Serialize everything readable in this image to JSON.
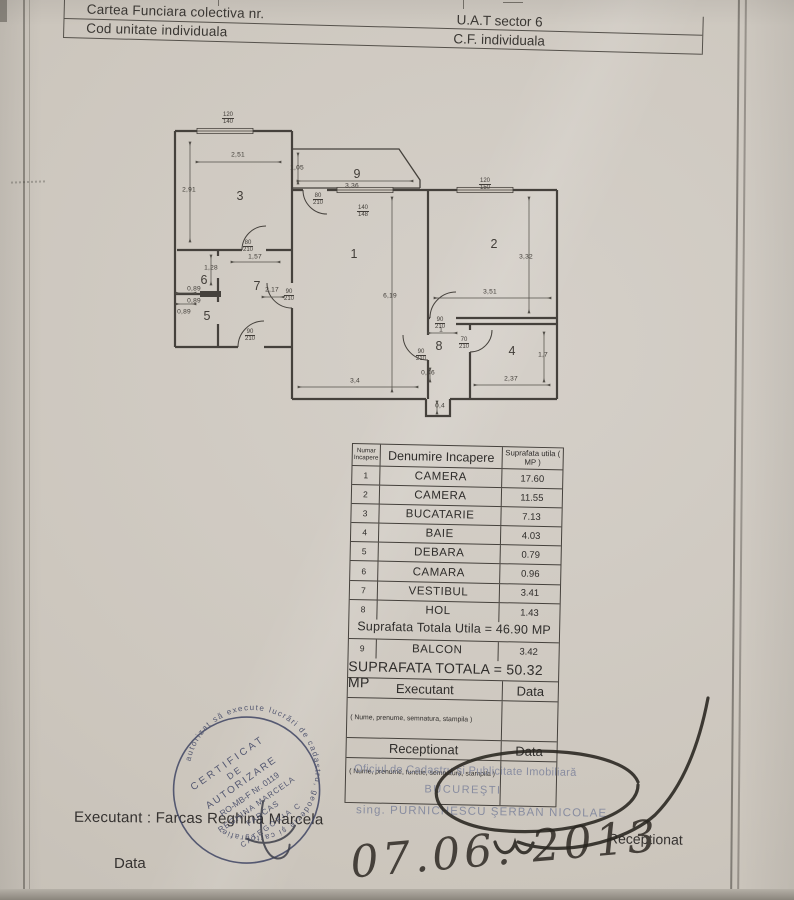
{
  "header": {
    "rows": [
      {
        "left": "Cartea Funciara colectiva nr.",
        "right": "U.A.T sector 6"
      },
      {
        "left": "Cod unitate individuala",
        "right": "C.F. individuala"
      }
    ]
  },
  "floorplan": {
    "room_numbers": [
      {
        "t": "3",
        "x": 240,
        "y": 196
      },
      {
        "t": "9",
        "x": 357,
        "y": 174
      },
      {
        "t": "1",
        "x": 354,
        "y": 254
      },
      {
        "t": "2",
        "x": 494,
        "y": 244
      },
      {
        "t": "4",
        "x": 512,
        "y": 351
      },
      {
        "t": "6",
        "x": 204,
        "y": 280
      },
      {
        "t": "7",
        "x": 257,
        "y": 286
      },
      {
        "t": "5",
        "x": 207,
        "y": 316
      },
      {
        "t": "8",
        "x": 439,
        "y": 346
      }
    ],
    "dimensions": [
      {
        "t": "2,51",
        "x": 238,
        "y": 155
      },
      {
        "t": "2,91",
        "x": 189,
        "y": 190
      },
      {
        "t": "1,05",
        "x": 297,
        "y": 168
      },
      {
        "t": "3,36",
        "x": 352,
        "y": 186
      },
      {
        "t": "6,19",
        "x": 390,
        "y": 296
      },
      {
        "t": "3,4",
        "x": 355,
        "y": 381
      },
      {
        "t": "3,51",
        "x": 490,
        "y": 292
      },
      {
        "t": "3,32",
        "x": 526,
        "y": 257
      },
      {
        "t": "2,37",
        "x": 511,
        "y": 379
      },
      {
        "t": "1,7",
        "x": 543,
        "y": 355
      },
      {
        "t": "1,57",
        "x": 255,
        "y": 257
      },
      {
        "t": "1,28",
        "x": 211,
        "y": 268
      },
      {
        "t": "0,89",
        "x": 194,
        "y": 289
      },
      {
        "t": "0,89",
        "x": 194,
        "y": 301
      },
      {
        "t": "0,89",
        "x": 184,
        "y": 312
      },
      {
        "t": "2,17",
        "x": 272,
        "y": 290
      },
      {
        "t": "1",
        "x": 441,
        "y": 330
      },
      {
        "t": "0,46",
        "x": 428,
        "y": 373
      },
      {
        "t": "0,4",
        "x": 440,
        "y": 406
      }
    ],
    "openings": [
      {
        "n": "120",
        "d": "140",
        "x": 228,
        "y": 112
      },
      {
        "n": "140",
        "d": "148",
        "x": 363,
        "y": 205
      },
      {
        "n": "120",
        "d": "150",
        "x": 485,
        "y": 178
      },
      {
        "n": "80",
        "d": "210",
        "x": 248,
        "y": 240
      },
      {
        "n": "80",
        "d": "210",
        "x": 318,
        "y": 193
      },
      {
        "n": "90",
        "d": "210",
        "x": 289,
        "y": 289
      },
      {
        "n": "90",
        "d": "210",
        "x": 250,
        "y": 329
      },
      {
        "n": "90",
        "d": "210",
        "x": 440,
        "y": 317
      },
      {
        "n": "70",
        "d": "210",
        "x": 464,
        "y": 337
      },
      {
        "n": "90",
        "d": "210",
        "x": 421,
        "y": 349
      }
    ]
  },
  "table": {
    "col_headers": [
      "Numar Incapere",
      "Denumire Incapere",
      "Suprafata utila ( MP )"
    ],
    "rows": [
      [
        "1",
        "CAMERA",
        "17.60"
      ],
      [
        "2",
        "CAMERA",
        "11.55"
      ],
      [
        "3",
        "BUCATARIE",
        "7.13"
      ],
      [
        "4",
        "BAIE",
        "4.03"
      ],
      [
        "5",
        "DEBARA",
        "0.79"
      ],
      [
        "6",
        "CAMARA",
        "0.96"
      ],
      [
        "7",
        "VESTIBUL",
        "3.41"
      ],
      [
        "8",
        "HOL",
        "1.43"
      ]
    ],
    "subtotal": "Suprafata Totala Utila = 46.90 MP",
    "balcon": [
      "9",
      "BALCON",
      "3.42"
    ],
    "total": "SUPRAFATA TOTALA = 50.32 MP",
    "executant": "Executant",
    "data1": "Data",
    "note1": "( Nume, prenume, semnatura, stampila )",
    "receptionat": "Receptionat",
    "data2": "Data",
    "note2": "( Nume, prenume, functie, semnatura, stampila )"
  },
  "stamp_overlay": {
    "office": "Oficiul de Cadastru şi Publicitate Imobiliară",
    "city": "BUCUREŞTI",
    "inspector": "sing. PURNICHESCU ŞERBAN NICOLAE"
  },
  "round_stamp": {
    "ring": "autorizat să execute lucrări de cadastru, geodezie şi cartografie",
    "line1": "CERTIFICAT",
    "line2": "DE",
    "line3": "AUTORIZARE",
    "line4": "RO-MB-F Nr. 0119",
    "line5": "REGHINA MARCELA",
    "line6": "FARCAS",
    "line7": "CATEGORIA C"
  },
  "footer": {
    "executant": "Executant : Farcas Reghina Marcela",
    "data": "Data",
    "receptionat": "Receptionat",
    "handwritten_date": "07.06. 2013"
  }
}
